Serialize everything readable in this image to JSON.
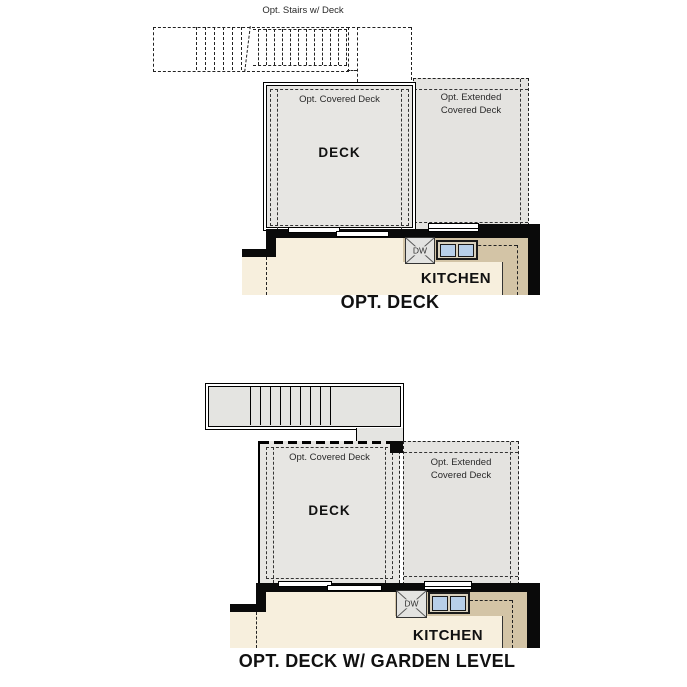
{
  "colors": {
    "deck_fill": "#e7e6e3",
    "ext_fill": "#e4e3e0",
    "stairs_fill": "#e4e4e1",
    "floor_cream": "#f7efdd",
    "counter_tan": "#d3c4a6",
    "sink_blue": "#b7cfe9",
    "wall": "#0a0a0a",
    "line": "#222222"
  },
  "figure1": {
    "title": "OPT. DECK",
    "stairs_label": "Opt. Stairs w/ Deck",
    "covered_deck_label": "Opt. Covered Deck",
    "deck_label": "DECK",
    "extended_deck_line1": "Opt. Extended",
    "extended_deck_line2": "Covered Deck",
    "kitchen_label": "KITCHEN",
    "dishwasher_label": "DW"
  },
  "figure2": {
    "title": "OPT. DECK W/ GARDEN LEVEL",
    "covered_deck_label": "Opt. Covered Deck",
    "deck_label": "DECK",
    "extended_deck_line1": "Opt. Extended",
    "extended_deck_line2": "Covered Deck",
    "kitchen_label": "KITCHEN",
    "dishwasher_label": "DW"
  }
}
